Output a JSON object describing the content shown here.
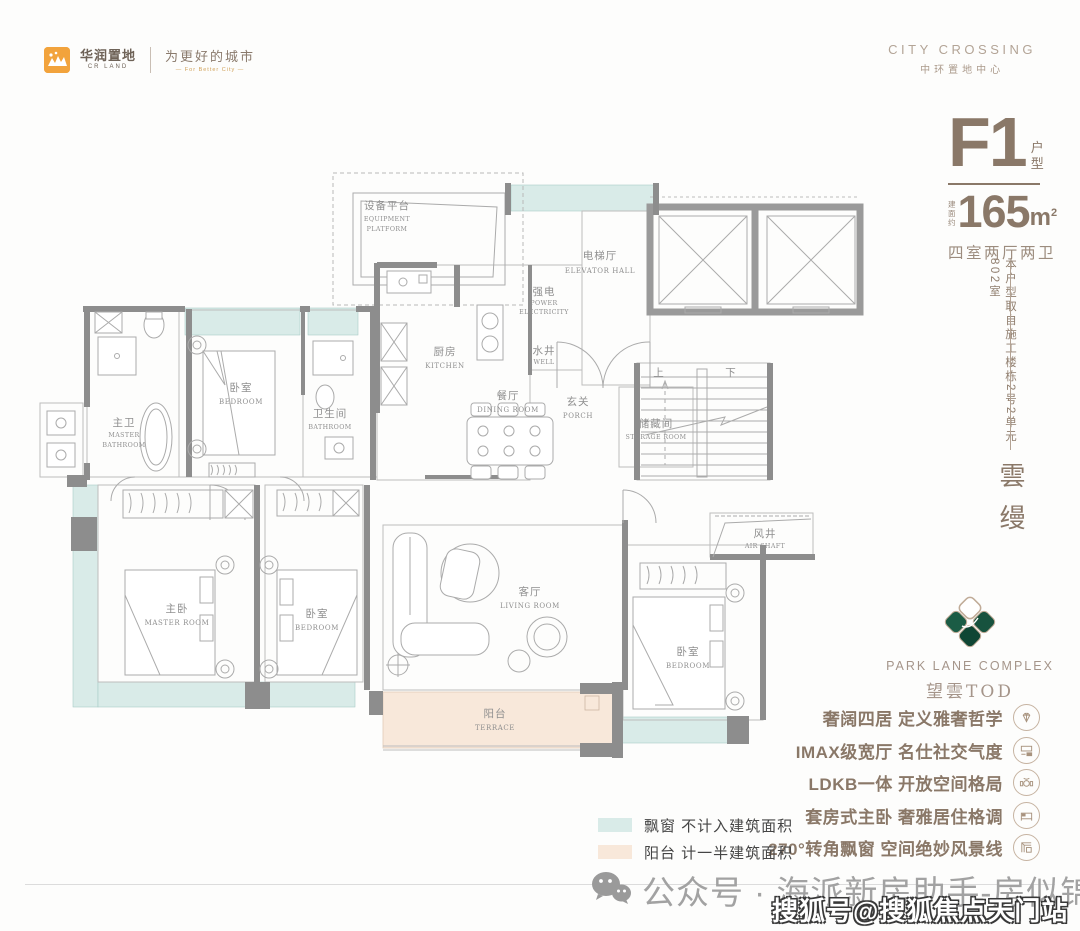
{
  "header": {
    "logo_zh": "华润置地",
    "logo_en": "CR LAND",
    "slogan_zh": "为更好的城市",
    "slogan_en": "— For Better City —",
    "project_en": "CITY CROSSING",
    "project_zh": "中环置地中心"
  },
  "unit": {
    "code": "F1",
    "type_label_1": "户",
    "type_label_2": "型",
    "area_prefix_1": "建面",
    "area_prefix_2": "约",
    "area_value": "165",
    "area_unit": "m",
    "area_sup": "2",
    "layout": "四室两厅两卫",
    "source_note": "本户型取自施工楼栋2号2单元802室",
    "series_name": "雲缦"
  },
  "brand": {
    "name_en": "PARK LANE COMPLEX",
    "name_zh": "望雲TOD"
  },
  "features": [
    {
      "text": "奢阔四居 定义雅奢哲学",
      "icon": "diamond-icon"
    },
    {
      "text": "IMAX级宽厅 名仕社交气度",
      "icon": "screen-icon"
    },
    {
      "text": "LDKB一体 开放空间格局",
      "icon": "dining-icon"
    },
    {
      "text": "套房式主卧 奢雅居住格调",
      "icon": "bed-icon"
    },
    {
      "text": "270°转角飘窗 空间绝妙风景线",
      "icon": "corner-window-icon"
    }
  ],
  "legend": [
    {
      "swatch": "#d9ebe8",
      "label": "飘窗 不计入建筑面积"
    },
    {
      "swatch": "#f8e8da",
      "label": "阳台 计一半建筑面积"
    }
  ],
  "footer": {
    "wechat_line": "公众号 · 海派新房助手-房似锦",
    "watermark": "搜狐号@搜狐焦点天门站"
  },
  "colors": {
    "bay_window": "#d9ebe8",
    "terrace": "#f8e8da",
    "accent_brown": "#8a7868",
    "wall_gray": "#8d8d8d"
  },
  "plan": {
    "equipment": {
      "zh": "设备平台",
      "en1": "EQUIPMENT",
      "en2": "PLATFORM"
    },
    "kitchen": {
      "zh": "厨房",
      "en": "KITCHEN"
    },
    "power": {
      "zh": "强电",
      "en1": "POWER",
      "en2": "ELECTRICITY"
    },
    "well": {
      "zh": "水井",
      "en": "WELL"
    },
    "elevator_hall": {
      "zh": "电梯厅",
      "en": "ELEVATOR HALL"
    },
    "porch": {
      "zh": "玄关",
      "en": "PORCH"
    },
    "dining": {
      "zh": "餐厅",
      "en": "DINING ROOM"
    },
    "storage": {
      "zh": "储藏间",
      "en": "STORAGE ROOM"
    },
    "stairs_up": "上",
    "stairs_down": "下",
    "air_shaft": {
      "zh": "风井",
      "en": "AIR SHAFT"
    },
    "master_bath": {
      "zh": "主卫",
      "en1": "MASTER",
      "en2": "BATHROOM"
    },
    "bedroom_top": {
      "zh": "卧室",
      "en": "BEDROOM"
    },
    "bath2": {
      "zh": "卫生间",
      "en": "BATHROOM"
    },
    "living": {
      "zh": "客厅",
      "en": "LIVING ROOM"
    },
    "master_room": {
      "zh": "主卧",
      "en": "MASTER ROOM"
    },
    "bedroom_mid": {
      "zh": "卧室",
      "en": "BEDROOM"
    },
    "bedroom_right": {
      "zh": "卧室",
      "en": "BEDROOM"
    },
    "terrace": {
      "zh": "阳台",
      "en": "TERRACE"
    }
  }
}
